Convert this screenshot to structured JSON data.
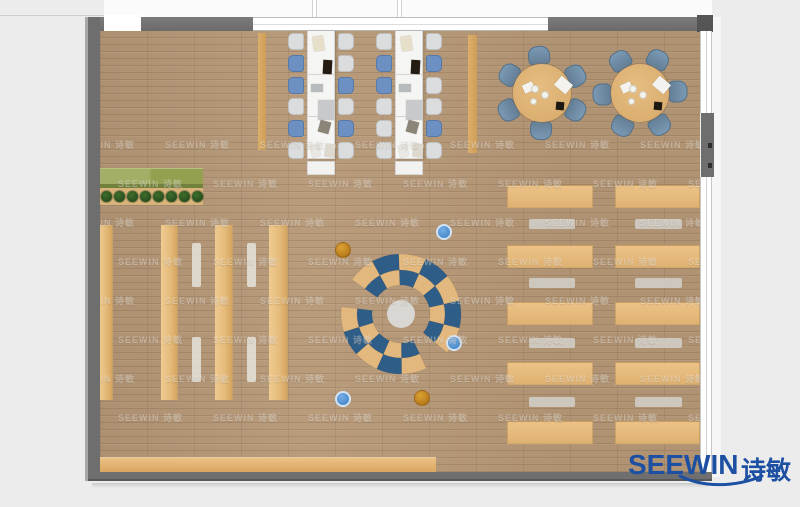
{
  "logo": {
    "brand": "SEEWIN",
    "brand_cn": "诗敏",
    "color": "#1d4fa2"
  },
  "watermark": {
    "text": "SEEWIN 诗敏",
    "rows": 8,
    "cols": 8,
    "x0": -30,
    "y0": 108,
    "dx": 95,
    "dy": 39,
    "stagger": 48
  },
  "palette": {
    "floor": "#b69877",
    "wall": "#6f6f6f",
    "shelf_tan": "#e8c084",
    "table_white": "#f5f5f3",
    "chair_light": "#dadcdd",
    "chair_blue": "#6b90c1",
    "round_chair": "#7190ab",
    "arc_blue": "#2e5e88",
    "arc_tan": "#e2b87e",
    "center_rug": "#d8d7d4",
    "ball_orange": "#c8861d",
    "ball_blue": "#4f93d6",
    "planter_green": "#9aa65a",
    "logo_blue": "#1d4fa2"
  },
  "furniture": {
    "planter": {
      "x": 98,
      "y": 168,
      "w": 105,
      "h": 20,
      "base_y": 188,
      "base_h": 17,
      "plant_count": 8,
      "plant_y": 196,
      "plant_x0": 106,
      "plant_dx": 13,
      "plant_r": 5.5
    },
    "shelves": [
      {
        "x": 98,
        "y": 225,
        "w": 15,
        "h": 175
      },
      {
        "x": 161,
        "y": 225,
        "w": 17,
        "h": 175
      },
      {
        "x": 215,
        "y": 225,
        "w": 18,
        "h": 175
      },
      {
        "x": 269,
        "y": 225,
        "w": 19,
        "h": 175
      }
    ],
    "shelf_benches": [
      {
        "x": 192,
        "y": 243,
        "w": 9,
        "h": 44
      },
      {
        "x": 192,
        "y": 337,
        "w": 9,
        "h": 45
      },
      {
        "x": 247,
        "y": 243,
        "w": 9,
        "h": 44
      },
      {
        "x": 247,
        "y": 337,
        "w": 9,
        "h": 45
      }
    ],
    "reading_area": {
      "col_x": [
        507,
        615
      ],
      "col_w": [
        86,
        85
      ],
      "table_y": [
        185,
        245,
        302,
        362,
        421
      ],
      "table_h": 23,
      "bench_x": [
        529,
        635
      ],
      "bench_w": [
        46,
        47
      ],
      "bench_y": [
        219,
        278,
        338,
        397
      ],
      "bench_h": 10
    },
    "bottom_shelf": {
      "x": 98,
      "y": 457,
      "w": 338,
      "h": 15
    },
    "panels": [
      {
        "x": 258,
        "y": 33,
        "w": 8,
        "h": 117
      },
      {
        "x": 468,
        "y": 35,
        "w": 9,
        "h": 118
      }
    ],
    "study_tables": [
      {
        "x": 307,
        "y": 28,
        "w": 28,
        "h": 131,
        "cap_h": 14,
        "chairs_left": [
          "light",
          "blue",
          "blue",
          "light",
          "blue",
          "light"
        ],
        "chairs_right": [
          "light",
          "light",
          "blue",
          "light",
          "blue",
          "light"
        ]
      },
      {
        "x": 395,
        "y": 28,
        "w": 28,
        "h": 131,
        "cap_h": 14,
        "chairs_left": [
          "light",
          "blue",
          "blue",
          "light",
          "light",
          "light"
        ],
        "chairs_right": [
          "light",
          "blue",
          "light",
          "light",
          "blue",
          "light"
        ]
      }
    ],
    "study_chair": {
      "w": 16,
      "h": 17,
      "gap": 3,
      "y0": 5,
      "dy": 21.8
    },
    "study_items": [
      {
        "x": 6,
        "y": 8,
        "w": 11,
        "h": 15,
        "r": -8,
        "c": "#e6dfc9"
      },
      {
        "x": 16,
        "y": 32,
        "w": 9,
        "h": 14,
        "r": 3,
        "c": "#241c12"
      },
      {
        "x": 4,
        "y": 56,
        "w": 12,
        "h": 8,
        "r": 0,
        "c": "#b9bcbe"
      },
      {
        "x": 11,
        "y": 72,
        "w": 16,
        "h": 20,
        "r": 0,
        "c": "#c7c9cb"
      },
      {
        "x": 12,
        "y": 93,
        "w": 11,
        "h": 12,
        "r": 15,
        "c": "#8d8478"
      },
      {
        "x": 4,
        "y": 117,
        "w": 9,
        "h": 12,
        "r": -12,
        "c": "#e9e8e4"
      },
      {
        "x": 18,
        "y": 116,
        "w": 10,
        "h": 13,
        "r": 6,
        "c": "#ddd9cf"
      }
    ],
    "round_tables": [
      {
        "cx": 542,
        "cy": 93,
        "r": 29,
        "chair_angles": [
          355,
          62,
          118,
          182,
          242,
          300
        ]
      },
      {
        "cx": 640,
        "cy": 93,
        "r": 29,
        "chair_angles": [
          28,
          88,
          148,
          208,
          268,
          328
        ]
      }
    ],
    "round_chair": {
      "w": 22,
      "h": 19,
      "dist": 38
    },
    "round_items": [
      {
        "type": "paper",
        "dx": 14,
        "dy": -14,
        "w": 15,
        "h": 12,
        "r": 40
      },
      {
        "type": "paper",
        "dx": -19,
        "dy": -10,
        "w": 11,
        "h": 9,
        "r": -25
      },
      {
        "type": "plate",
        "dx": -7,
        "dy": -4,
        "pr": 4
      },
      {
        "type": "plate",
        "dx": 3,
        "dy": 2,
        "pr": 4
      },
      {
        "type": "plate",
        "dx": -9,
        "dy": 8,
        "pr": 3.5
      },
      {
        "type": "dark",
        "dx": 14,
        "dy": 9,
        "w": 8,
        "h": 8,
        "r": 5
      }
    ],
    "lounge": {
      "cx": 401,
      "cy": 314,
      "center_r": 14,
      "bands": [
        {
          "r1": 29,
          "r2": 44,
          "a0": 305,
          "a1": 490,
          "n": 7,
          "phase": 1
        },
        {
          "r1": 44,
          "r2": 60,
          "a0": 305,
          "a1": 490,
          "n": 7,
          "phase": 0
        },
        {
          "r1": 29,
          "r2": 44,
          "a0": 155,
          "a1": 277,
          "n": 5,
          "phase": 1
        },
        {
          "r1": 44,
          "r2": 60,
          "a0": 155,
          "a1": 277,
          "n": 5,
          "phase": 0
        }
      ],
      "balls": [
        {
          "x": 343,
          "y": 250,
          "c": "orange"
        },
        {
          "x": 444,
          "y": 232,
          "c": "blue"
        },
        {
          "x": 454,
          "y": 343,
          "c": "blue"
        },
        {
          "x": 343,
          "y": 399,
          "c": "blue"
        },
        {
          "x": 422,
          "y": 398,
          "c": "orange"
        }
      ],
      "ball_r": 8
    }
  }
}
